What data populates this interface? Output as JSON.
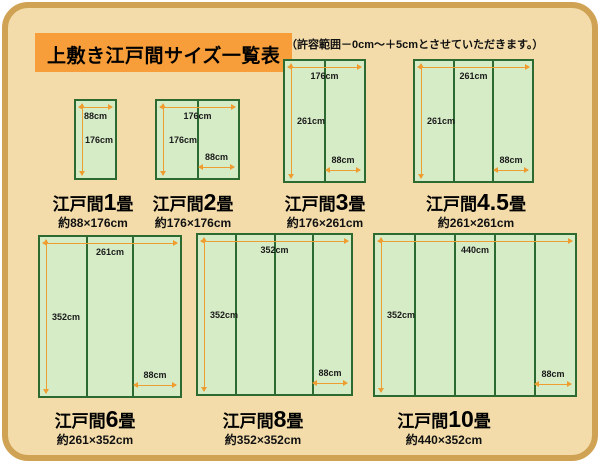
{
  "header": {
    "title": "上敷き江戸間サイズ一覧表",
    "note": "（許容範囲－0cm～＋5cmとさせていただきます。）"
  },
  "colors": {
    "frame": "#cfa254",
    "bg": "#f3dcaa",
    "title": "#f79e3a",
    "mat": "#d6ecc6",
    "matline": "#2d6a32",
    "arrow": "#ef9d31",
    "text": "#111111"
  },
  "diagrams": [
    {
      "name_prefix": "江戸間",
      "name_number": "1",
      "name_suffix": "畳",
      "approx_size": "約88×176cm",
      "width_dim": "88cm",
      "height_dim": "176cm",
      "mat_width_dim": "",
      "panels": 1
    },
    {
      "name_prefix": "江戸間",
      "name_number": "2",
      "name_suffix": "畳",
      "approx_size": "約176×176cm",
      "width_dim": "176cm",
      "height_dim": "176cm",
      "mat_width_dim": "88cm",
      "panels": 2
    },
    {
      "name_prefix": "江戸間",
      "name_number": "3",
      "name_suffix": "畳",
      "approx_size": "約176×261cm",
      "width_dim": "176cm",
      "height_dim": "261cm",
      "mat_width_dim": "88cm",
      "panels": 2
    },
    {
      "name_prefix": "江戸間",
      "name_number": "4.5",
      "name_suffix": "畳",
      "approx_size": "約261×261cm",
      "width_dim": "261cm",
      "height_dim": "261cm",
      "mat_width_dim": "88cm",
      "panels": 3
    },
    {
      "name_prefix": "江戸間",
      "name_number": "6",
      "name_suffix": "畳",
      "approx_size": "約261×352cm",
      "width_dim": "261cm",
      "height_dim": "352cm",
      "mat_width_dim": "88cm",
      "panels": 3
    },
    {
      "name_prefix": "江戸間",
      "name_number": "8",
      "name_suffix": "畳",
      "approx_size": "約352×352cm",
      "width_dim": "352cm",
      "height_dim": "352cm",
      "mat_width_dim": "88cm",
      "panels": 4
    },
    {
      "name_prefix": "江戸間",
      "name_number": "10",
      "name_suffix": "畳",
      "approx_size": "約440×352cm",
      "width_dim": "440cm",
      "height_dim": "352cm",
      "mat_width_dim": "88cm",
      "panels": 5
    }
  ]
}
